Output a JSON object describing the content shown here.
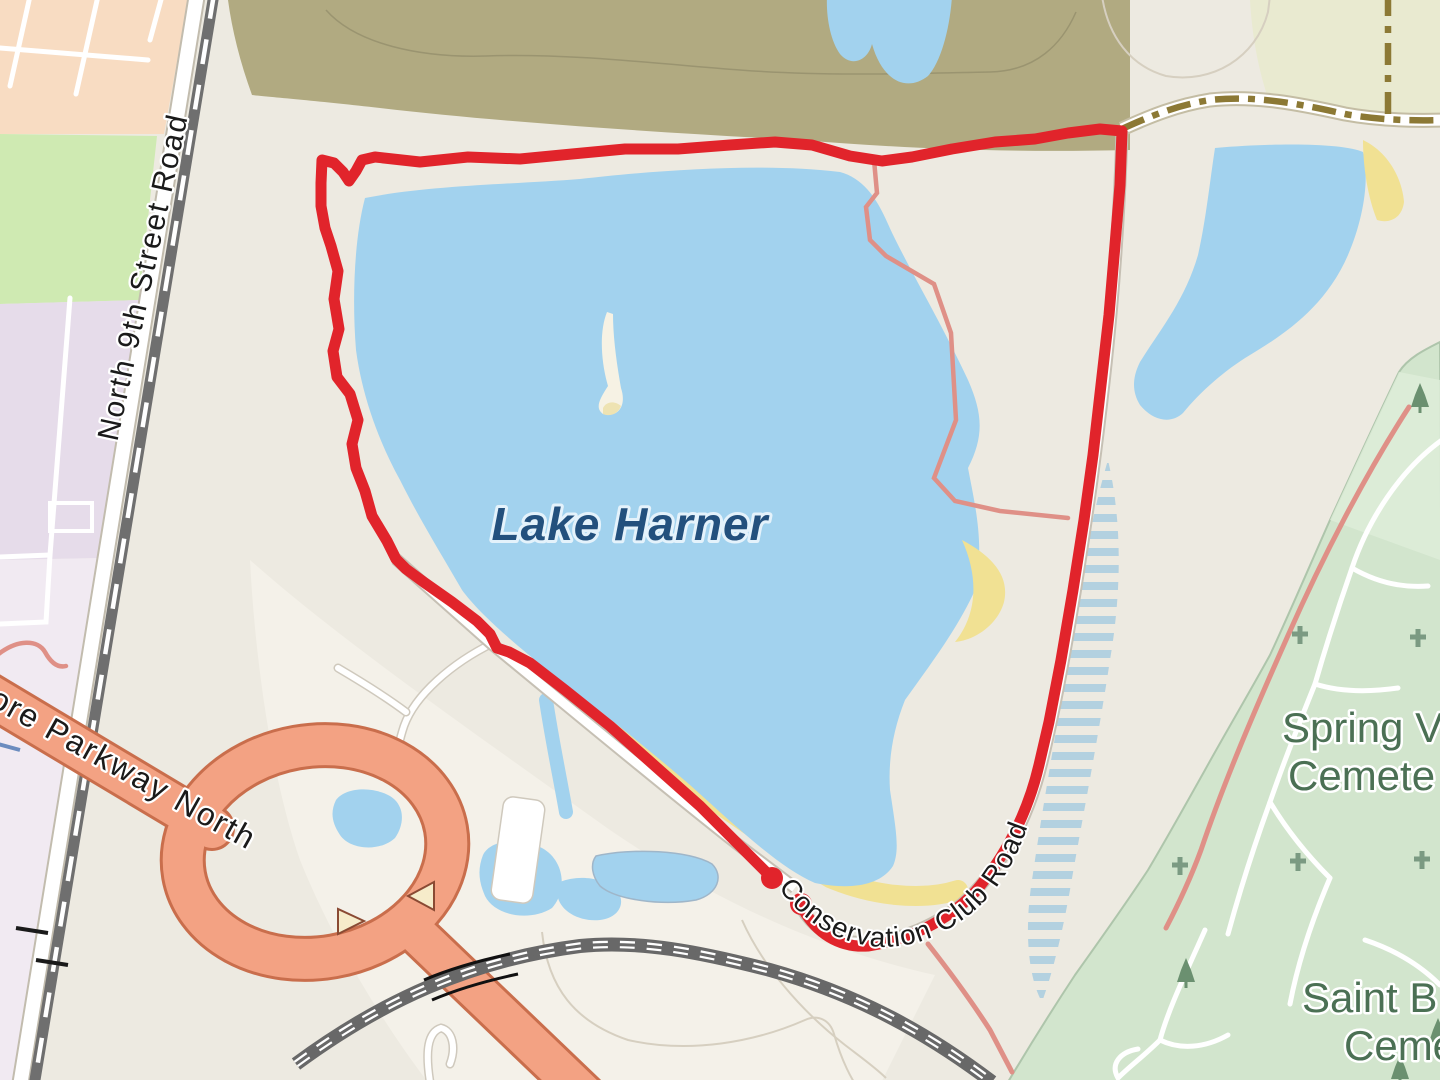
{
  "app": {
    "type": "map-view",
    "description": "Street/terrain map showing a recorded GPS activity route looping around Lake Harner"
  },
  "labels": {
    "lake": "Lake Harner",
    "road_north_9th": "North 9th Street Road",
    "road_parkway": "ore Parkway North",
    "road_conservation": "Conservation Club Road",
    "cemetery_spring_line1": "Spring V",
    "cemetery_spring_line2": "Cemete",
    "cemetery_saint_line1": "Saint B",
    "cemetery_saint_line2": "Ceme"
  },
  "route": {
    "color": "#e1242b",
    "shape": "closed loop around Lake Harner along Conservation Club Road",
    "marker_count": 2,
    "start_marker": "red endpoint dot",
    "end_marker": "red endpoint dot"
  },
  "map_colors": {
    "water": "#a2d2ee",
    "land": "#edeae1",
    "land_light": "#f4f1e9",
    "scrub_olive": "#b1aa81",
    "meadow_pale": "#e9ead0",
    "grass_green": "#cfeab2",
    "residential_peach": "#f8dcc2",
    "institution_lavender": "#e6dcea",
    "cemetery_green": "#d2e5cd",
    "beach_sand": "#f1e193",
    "wetland_stripe": "#b3d1e0",
    "trunk_road_salmon": "#f3a283",
    "track_dash_brown": "#8c7935",
    "railway_gray": "#6f6f6f",
    "construction_road_gray": "#686868",
    "minor_path_red": "#df9087"
  },
  "icons": {
    "cemetery_cross": "cemetery-cross-icon",
    "conifer_tree": "conifer-tree-icon",
    "oneway_arrow": "oneway-arrow-icon",
    "level_crossing": "level-crossing-icon",
    "route_marker": "route-endpoint-dot-icon"
  }
}
